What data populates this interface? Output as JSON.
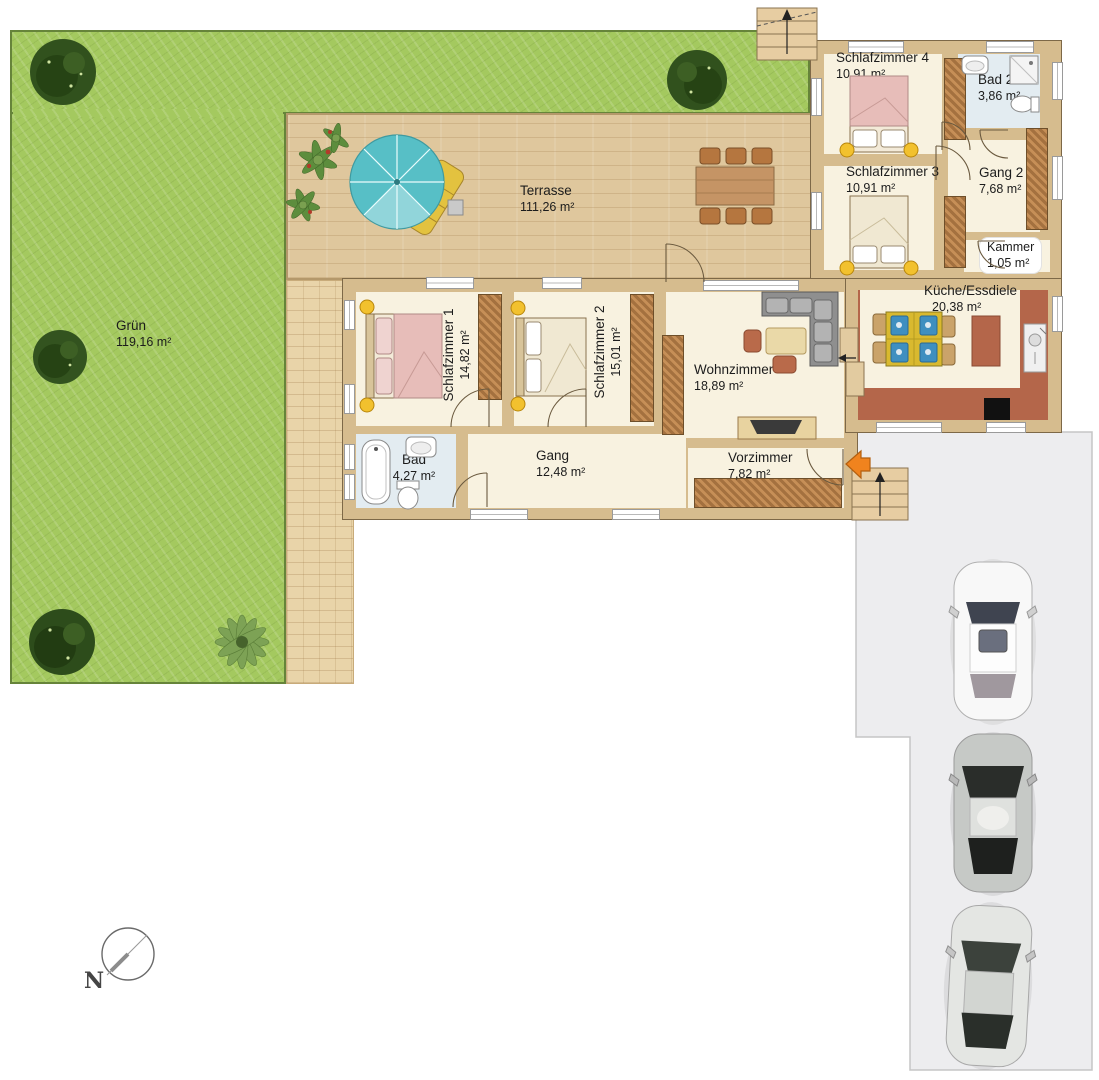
{
  "plan": {
    "compass_label": "N",
    "rooms": [
      {
        "id": "gruen",
        "name": "Grün",
        "area": "119,16 m²"
      },
      {
        "id": "terrasse",
        "name": "Terrasse",
        "area": "111,26 m²"
      },
      {
        "id": "schlafzimmer4",
        "name": "Schlafzimmer 4",
        "area": "10,91 m²"
      },
      {
        "id": "bad2",
        "name": "Bad 2",
        "area": "3,86 m²"
      },
      {
        "id": "schlafzimmer3",
        "name": "Schlafzimmer 3",
        "area": "10,91 m²"
      },
      {
        "id": "gang2",
        "name": "Gang 2",
        "area": "7,68 m²"
      },
      {
        "id": "kammer",
        "name": "Kammer",
        "area": "1,05 m²"
      },
      {
        "id": "kueche_essdiele",
        "name": "Küche/Essdiele",
        "area": "20,38 m²"
      },
      {
        "id": "schlafzimmer1",
        "name": "Schlafzimmer 1",
        "area": "14,82 m²"
      },
      {
        "id": "schlafzimmer2",
        "name": "Schlafzimmer 2",
        "area": "15,01 m²"
      },
      {
        "id": "wohnzimmer",
        "name": "Wohnzimmer",
        "area": "18,89 m²"
      },
      {
        "id": "bad",
        "name": "Bad",
        "area": "4,27 m²"
      },
      {
        "id": "gang",
        "name": "Gang",
        "area": "12,48 m²"
      },
      {
        "id": "vorzimmer",
        "name": "Vorzimmer",
        "area": "7,82 m²"
      }
    ],
    "colors": {
      "grass": "#a4c95f",
      "terrace_wood": "#dfc79d",
      "wall": "#d6bc8e",
      "room_floor": "#f8f2e0",
      "bath_floor": "#e3ecf1",
      "kitchen_tile": "#b4664a",
      "driveway": "#ededef",
      "entrance_arrow": "#f0831e",
      "bed_pink": "#e7bdb9",
      "umbrella": "#57bfc6",
      "lamp_yellow": "#f2c12e"
    }
  }
}
